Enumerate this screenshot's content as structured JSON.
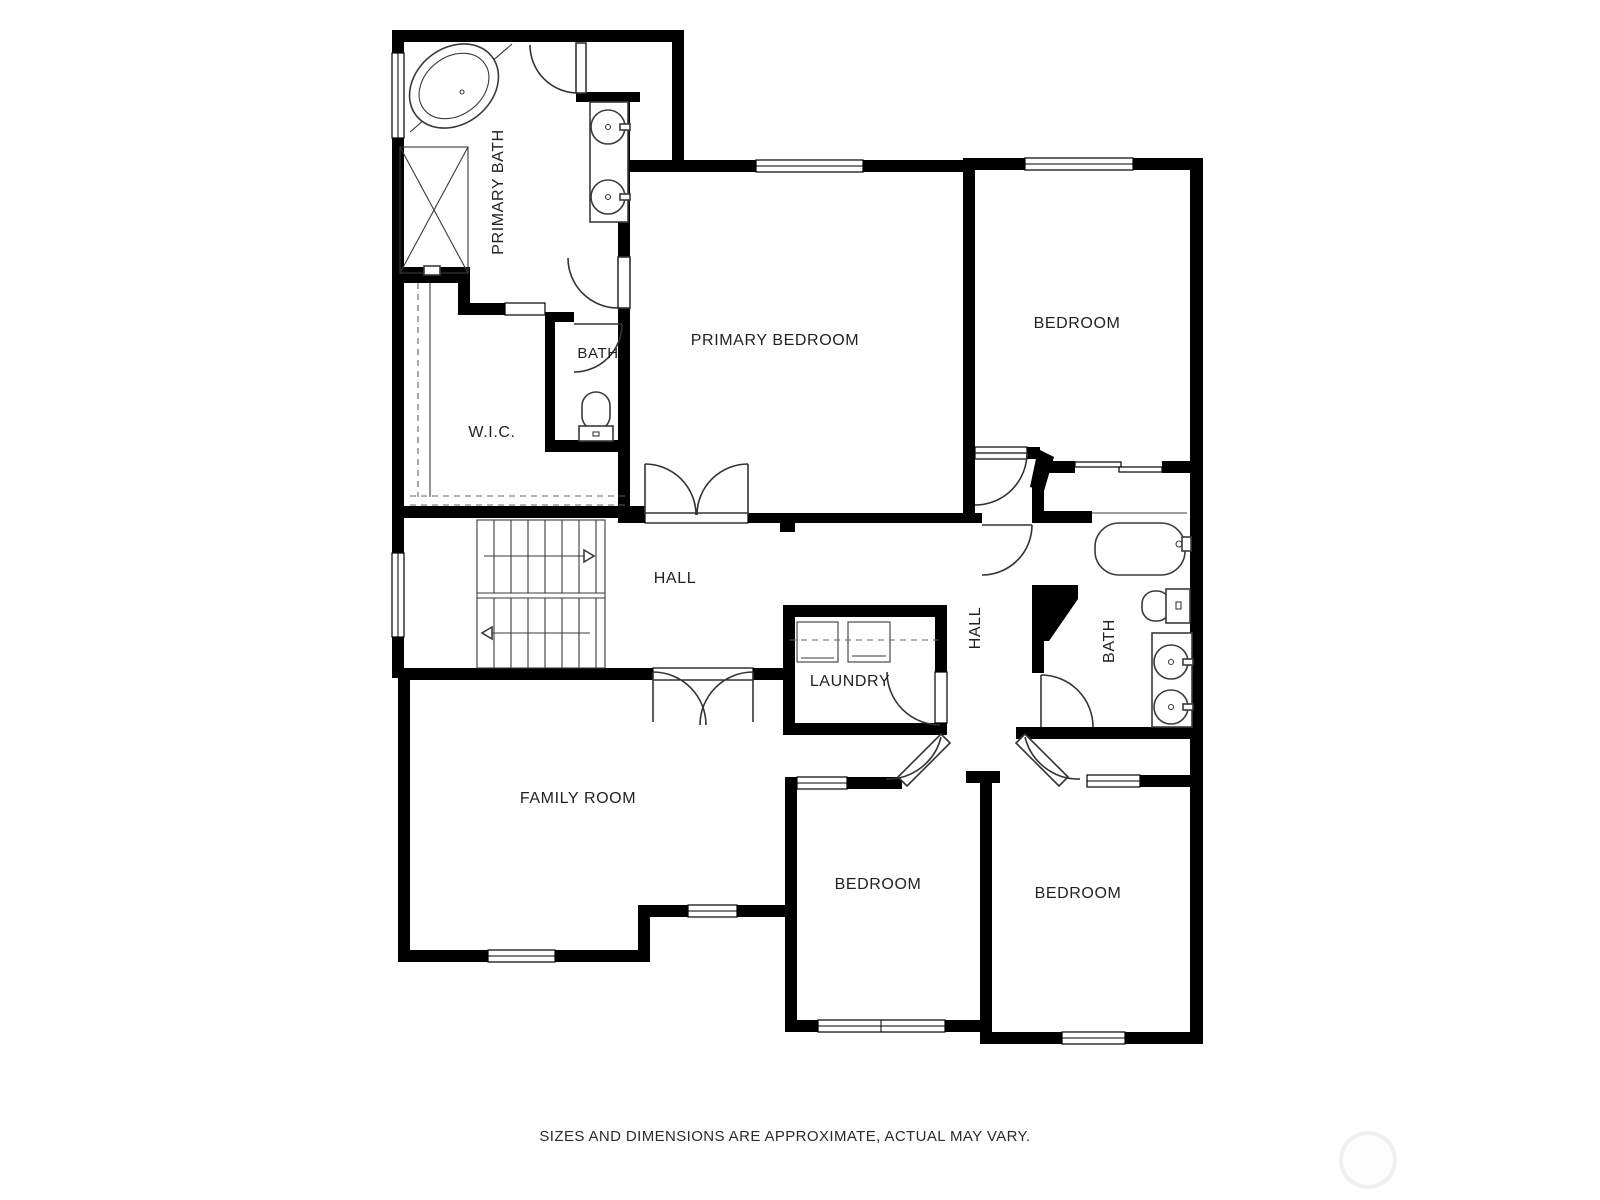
{
  "plan": {
    "type": "floor-plan",
    "colors": {
      "wall": "#000000",
      "background": "#ffffff",
      "label": "#222222",
      "fixture_line": "#3a3a3a"
    },
    "rooms": [
      {
        "id": "primary-bath",
        "label": "PRIMARY BATH",
        "orientation": "vertical"
      },
      {
        "id": "bath-wc",
        "label": "BATH",
        "orientation": "horizontal"
      },
      {
        "id": "wic",
        "label": "W.I.C.",
        "orientation": "horizontal"
      },
      {
        "id": "primary-bedroom",
        "label": "PRIMARY BEDROOM",
        "orientation": "horizontal"
      },
      {
        "id": "bedroom-top-right",
        "label": "BEDROOM",
        "orientation": "horizontal"
      },
      {
        "id": "hall",
        "label": "HALL",
        "orientation": "horizontal"
      },
      {
        "id": "hall-east",
        "label": "HALL",
        "orientation": "vertical"
      },
      {
        "id": "bath-east",
        "label": "BATH",
        "orientation": "vertical"
      },
      {
        "id": "laundry",
        "label": "LAUNDRY",
        "orientation": "horizontal"
      },
      {
        "id": "family-room",
        "label": "FAMILY ROOM",
        "orientation": "horizontal"
      },
      {
        "id": "bedroom-bottom-left",
        "label": "BEDROOM",
        "orientation": "horizontal"
      },
      {
        "id": "bedroom-bottom-right",
        "label": "BEDROOM",
        "orientation": "horizontal"
      }
    ],
    "fixtures": [
      "corner-tub",
      "shower",
      "double-vanity",
      "toilet",
      "stairs",
      "washer-dryer",
      "bathtub",
      "toilet",
      "double-vanity"
    ],
    "footer": {
      "disclaimer": "SIZES AND DIMENSIONS ARE APPROXIMATE, ACTUAL MAY VARY."
    }
  }
}
